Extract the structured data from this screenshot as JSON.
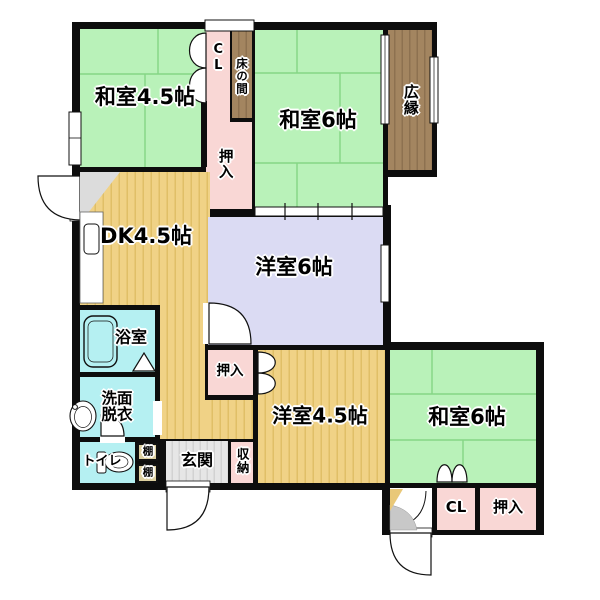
{
  "floorplan": {
    "type": "japanese-apartment-floorplan",
    "rooms": {
      "washitsu45": {
        "label": "和室4.5帖"
      },
      "cl_top": {
        "label": "CL"
      },
      "tokonoma": {
        "label": "床の間"
      },
      "oshiire_top": {
        "label": "押入"
      },
      "washitsu6_top": {
        "label": "和室6帖"
      },
      "hiroen": {
        "label": "広縁"
      },
      "dk": {
        "label": "DK4.5帖"
      },
      "yoshitsu6": {
        "label": "洋室6帖"
      },
      "bath": {
        "label": "浴室"
      },
      "senmen": {
        "label": "洗面脱衣"
      },
      "toilet": {
        "label": "トイレ"
      },
      "shelf_upper": {
        "label": "棚"
      },
      "shelf_lower": {
        "label": "棚"
      },
      "genkan": {
        "label": "玄関"
      },
      "shuunou": {
        "label": "収納"
      },
      "oshiire_mid": {
        "label": "押入"
      },
      "yoshitsu45": {
        "label": "洋室4.5帖"
      },
      "washitsu6_btm": {
        "label": "和室6帖"
      },
      "cl_btm": {
        "label": "CL"
      },
      "oshiire_btm": {
        "label": "押入"
      }
    },
    "colors": {
      "tatami-green": "#b9f2b9",
      "tatami-seam": "#85d685",
      "closet-pink": "#f9d7d5",
      "wood-tan": "#f0d286",
      "wood-tan-stripe": "#e0bf67",
      "western-lavender": "#dbdbf3",
      "wet-cyan": "#b5f0f2",
      "engawa-brown": "#a38560",
      "engawa-brown-stripe": "#8d7150",
      "entry-gray": "#e6e6e6",
      "entry-gray-stripe": "#d2d2d2",
      "wall-black": "#0d0d0d"
    }
  }
}
